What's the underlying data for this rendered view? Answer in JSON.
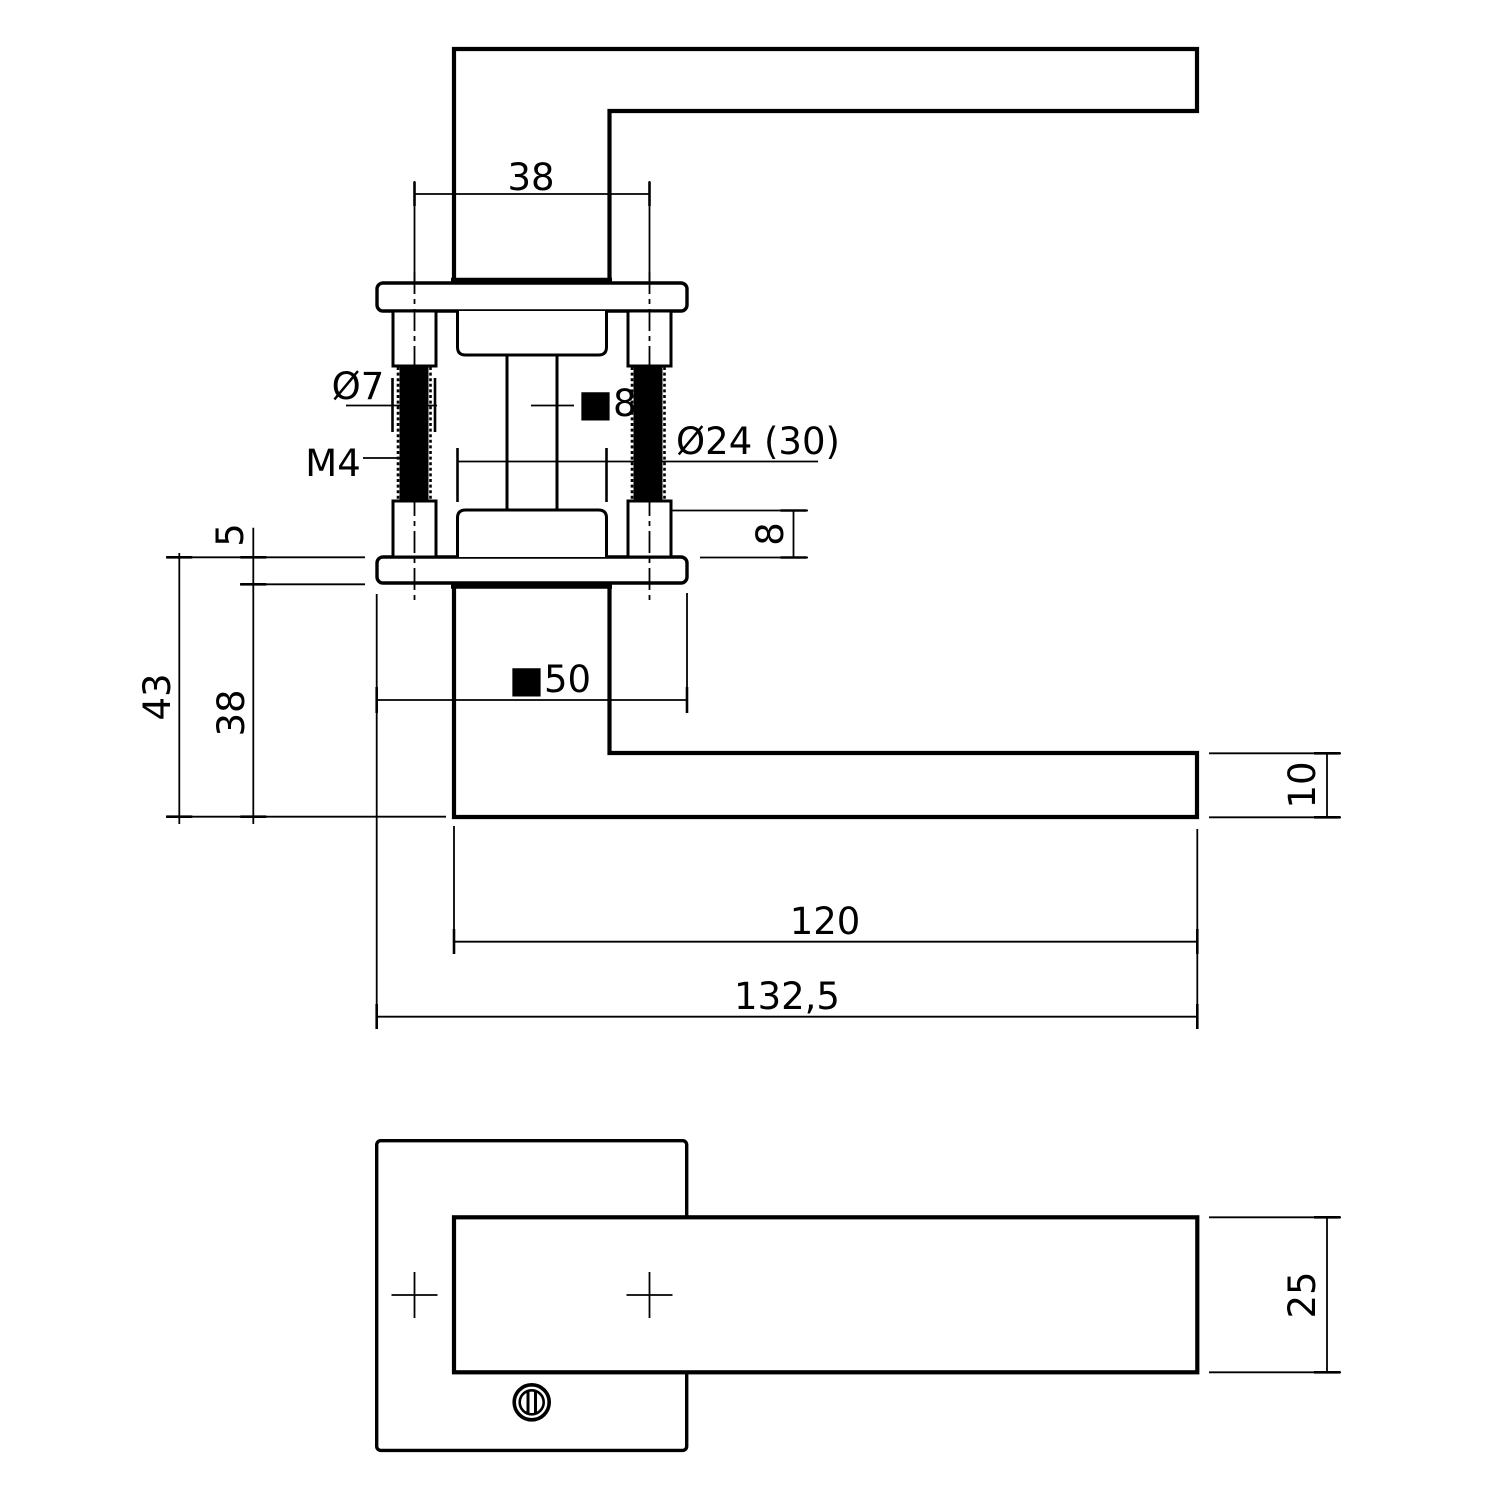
{
  "page": {
    "background": "#ffffff",
    "line_color": "#000000"
  },
  "side_view": {
    "labels": {
      "screw_spacing": "38",
      "sleeve_diameter": "Ø7",
      "thread_size": "M4",
      "spindle_size": "■8",
      "rose_diameter": "Ø24 (30)",
      "collar_height": "8",
      "rose_thickness": "5",
      "total_projection": "43",
      "body_height": "38",
      "rose_square": "■50",
      "lever_thickness": "10",
      "lever_length": "120",
      "total_length": "132,5"
    }
  },
  "top_view": {
    "labels": {
      "lever_width": "25"
    },
    "symbols": {
      "screw_head": "slotted-screw-icon",
      "hole_marker": "cross-marker-icon"
    }
  }
}
